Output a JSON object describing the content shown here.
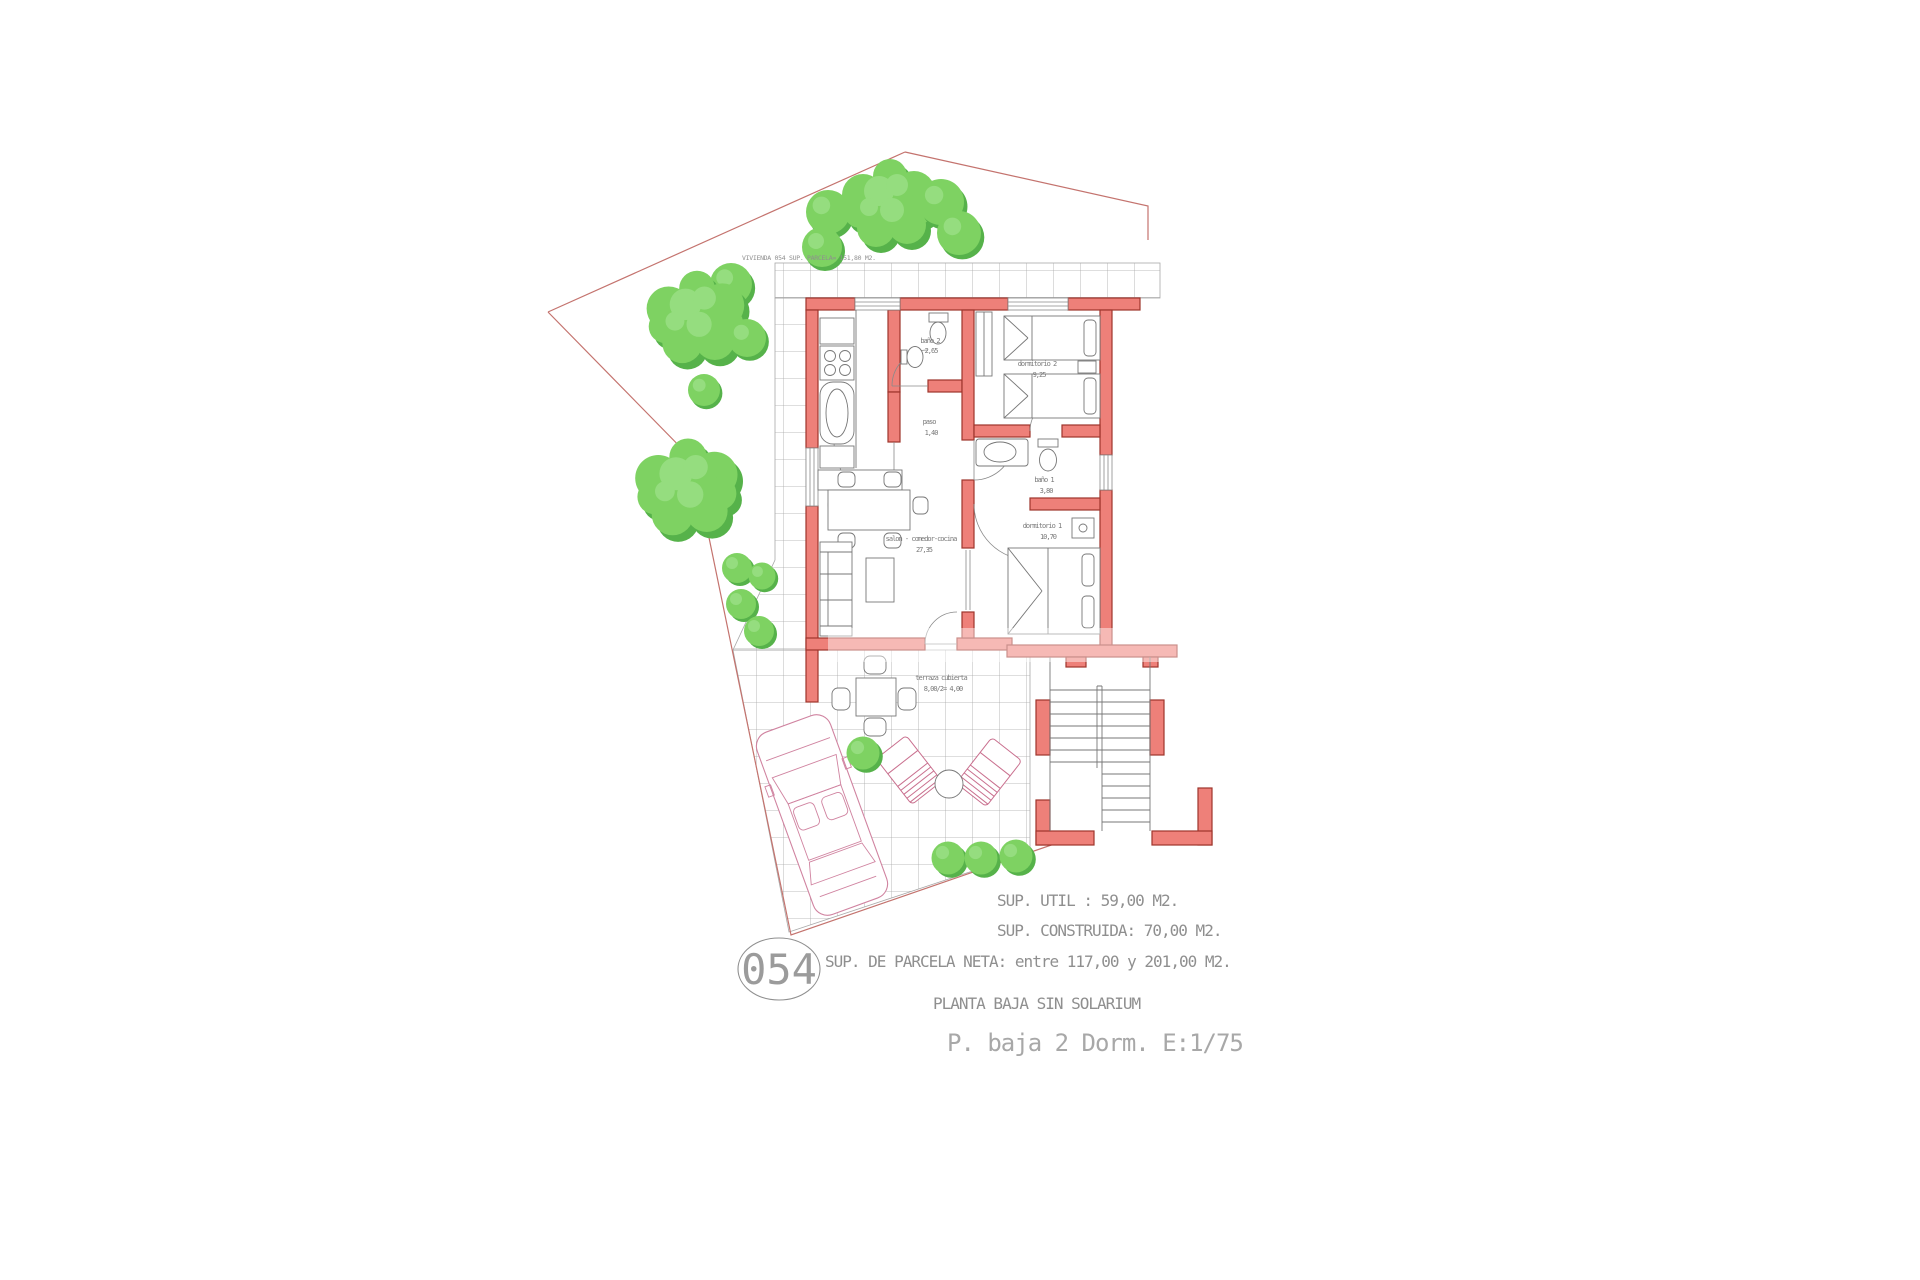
{
  "site": {
    "parcel_label": "VIVIENDA 054 SUP. PARCELA= 151,80 M2.",
    "unit_number": "054"
  },
  "rooms": [
    {
      "name": "baño 2",
      "area": "2,65"
    },
    {
      "name": "paso",
      "area": "1,40"
    },
    {
      "name": "dormitorio 2",
      "area": "9,25"
    },
    {
      "name": "baño 1",
      "area": "3,80"
    },
    {
      "name": "dormitorio 1",
      "area": "10,70"
    },
    {
      "name": "salon - comedor-cocina",
      "area": "27,35"
    },
    {
      "name": "terraza cubierta",
      "area": "8,00/2= 4,00"
    }
  ],
  "summary": {
    "sup_util": "SUP. UTIL : 59,00 M2.",
    "sup_construida": "SUP. CONSTRUIDA: 70,00 M2.",
    "sup_parcela_neta": "SUP. DE PARCELA NETA: entre 117,00 y 201,00 M2.",
    "floor_label": "PLANTA BAJA SIN SOLARIUM",
    "drawing_label": "P. baja 2 Dorm. E:1/75"
  },
  "colors": {
    "wall_fill": "#ee8079",
    "wall_stroke": "#9e352c",
    "tree_green": "#7ed262",
    "tree_dark": "#56b24a",
    "tree_light": "#95dd7f",
    "boundary_pink": "#c4736e",
    "grid_gray": "#a8a8a8",
    "line_gray": "#777777",
    "text_gray": "#8f8f8f",
    "car_pink": "#d083a0"
  }
}
